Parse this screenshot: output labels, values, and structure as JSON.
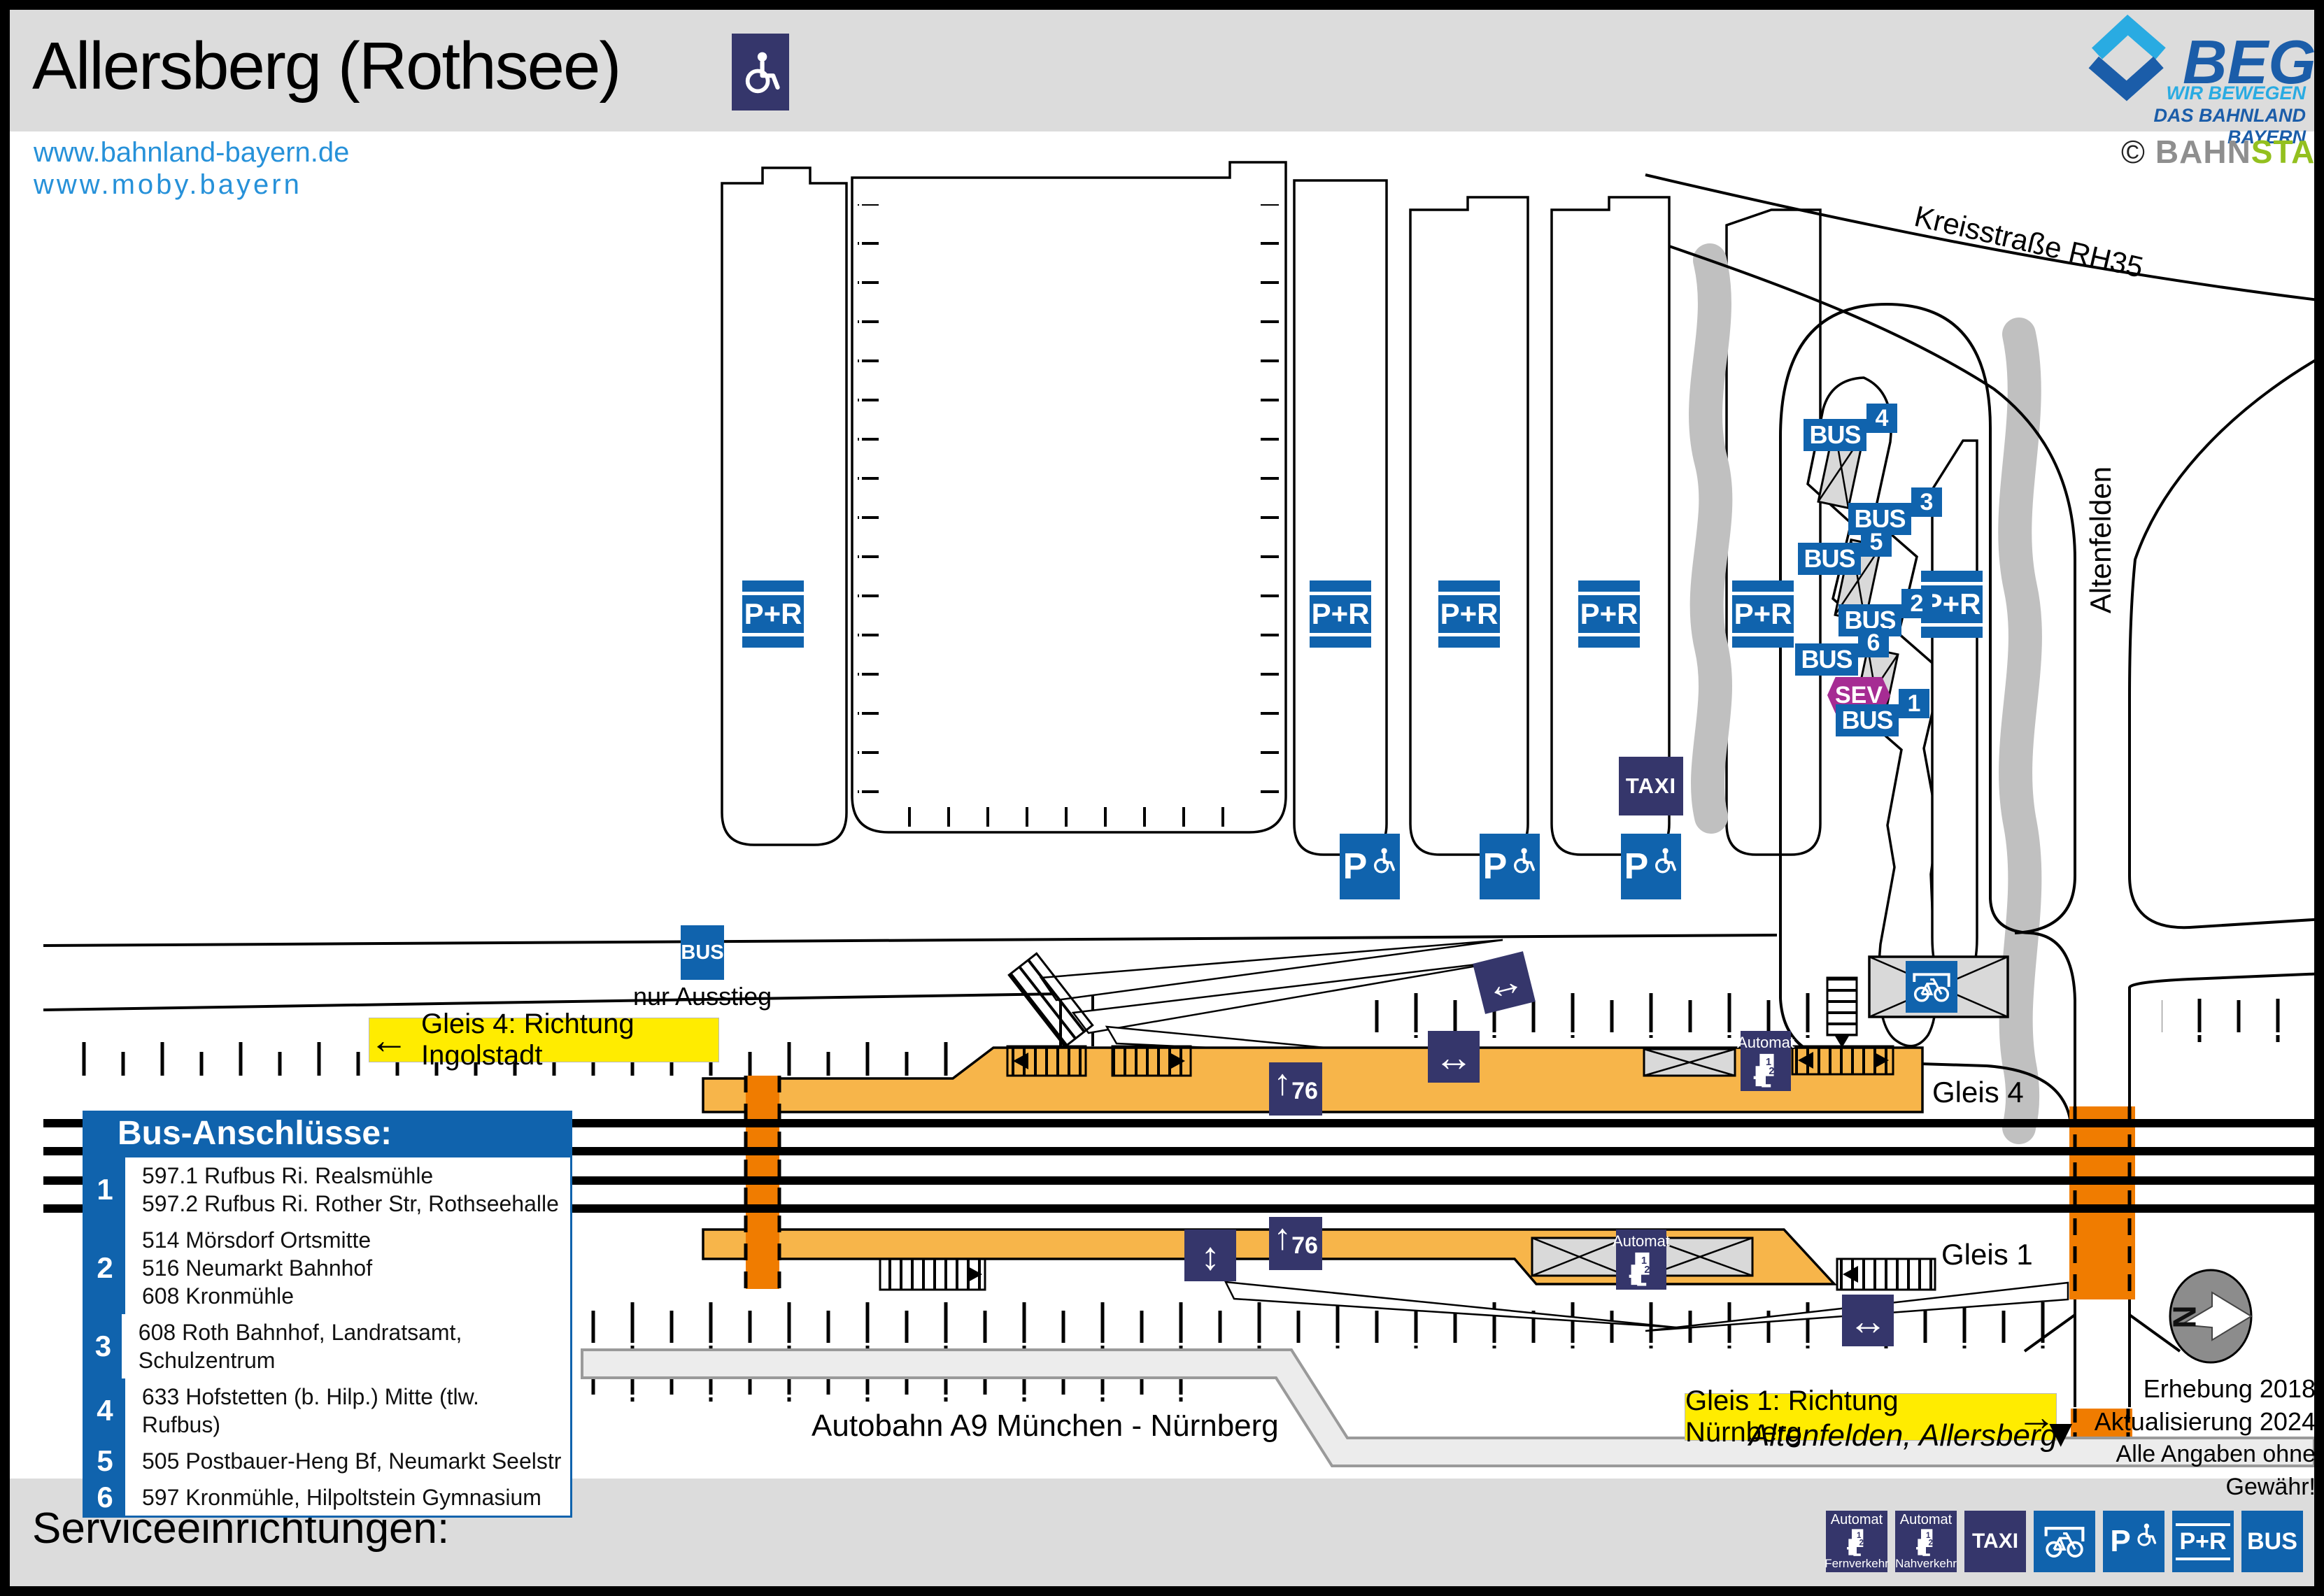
{
  "header": {
    "title": "Allersberg (Rothsee)",
    "urls": [
      "www.bahnland-bayern.de",
      "www.moby.bayern"
    ],
    "logo": {
      "name": "BEG",
      "tagline1": "WIR BEWEGEN",
      "tagline2": "DAS BAHNLAND BAYERN"
    },
    "credit": {
      "copyright": "©",
      "part1": "BAHN",
      "part2": "STADT"
    }
  },
  "map": {
    "roads": {
      "kreisstrasse": "Kreisstraße RH35",
      "altenfelden": "Altenfelden",
      "autobahn": "Autobahn A9 München - Nürnberg",
      "altenfelden_allersberg": "Altenfelden, Allersberg"
    },
    "banners": {
      "gleis4": "Gleis 4: Richtung Ingolstadt",
      "gleis1": "Gleis 1: Richtung Nürnberg"
    },
    "labels": {
      "gleis4": "Gleis 4",
      "gleis1": "Gleis 1",
      "nur_ausstieg": "nur Ausstieg",
      "platform_height": "76",
      "compass": "N"
    },
    "signs": {
      "bus": "BUS",
      "pr": "P+R",
      "taxi": "TAXI",
      "sev": "SEV",
      "automat": "Automat",
      "p": "P"
    },
    "icons": {
      "arrow_left": "←",
      "arrow_right": "→",
      "arrow_down_filled": "▼",
      "up_arrow": "↑",
      "h_arrows": "↔",
      "v_arrows": "↕"
    },
    "bus_stops": [
      {
        "number": "1"
      },
      {
        "number": "2"
      },
      {
        "number": "3"
      },
      {
        "number": "4"
      },
      {
        "number": "5"
      },
      {
        "number": "6"
      }
    ],
    "notes": {
      "line1": "Erhebung 2018",
      "line2": "Aktualisierung 2024",
      "line3": "Alle Angaben ohne Gewähr!"
    }
  },
  "legend": {
    "title": "Bus-Anschlüsse:",
    "items": [
      {
        "number": "1",
        "text": "597.1 Rufbus Ri. Realsmühle\n597.2 Rufbus Ri. Rother Str, Rothseehalle"
      },
      {
        "number": "2",
        "text": "514 Mörsdorf Ortsmitte\n516 Neumarkt Bahnhof\n608 Kronmühle"
      },
      {
        "number": "3",
        "text": "608 Roth Bahnhof, Landratsamt, Schulzentrum"
      },
      {
        "number": "4",
        "text": "633 Hofstetten (b. Hilp.) Mitte (tlw. Rufbus)"
      },
      {
        "number": "5",
        "text": "505 Postbauer-Heng Bf, Neumarkt Seelstr"
      },
      {
        "number": "6",
        "text": "597 Kronmühle, Hilpoltstein Gymnasium"
      }
    ]
  },
  "footer": {
    "title": "Serviceeinrichtungen:",
    "icons": [
      {
        "name": "automat-fernverkehr",
        "top": "Automat",
        "bottom": "Fernverkehr"
      },
      {
        "name": "automat-nahverkehr",
        "top": "Automat",
        "bottom": "Nahverkehr"
      },
      {
        "name": "taxi",
        "label": "TAXI"
      },
      {
        "name": "bike-shelter",
        "label": ""
      },
      {
        "name": "parking-disabled",
        "label": "P"
      },
      {
        "name": "park-and-ride",
        "label": "P+R"
      },
      {
        "name": "bus",
        "label": "BUS"
      }
    ]
  },
  "colors": {
    "sign_blue": "#1063ad",
    "sign_navy": "#35366b",
    "sev_purple": "#a62c93",
    "platform_amber": "#f7b54a",
    "crossing_orange": "#f07c00",
    "banner_yellow": "#ffec00",
    "tree_gray": "#c0c0c0",
    "band_gray": "#dcdcdc"
  }
}
